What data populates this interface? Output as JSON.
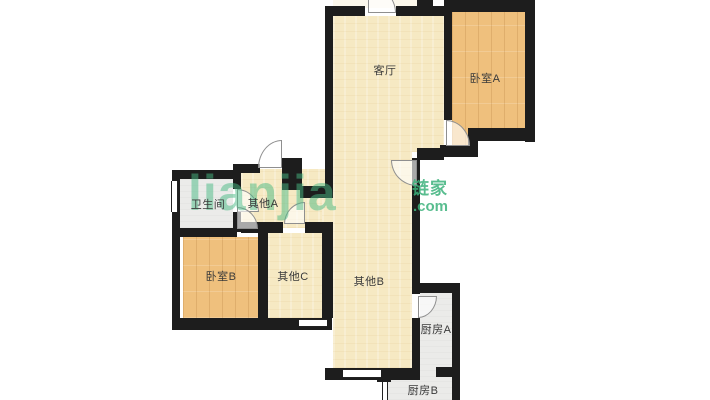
{
  "watermark": {
    "logo": "lianjia",
    "brand": "链家",
    "tld": ".com",
    "color": "#48b983"
  },
  "colors": {
    "wall": "#1d1d1d",
    "room_beige": "#f6e9c3",
    "room_wood": "#efc07d",
    "room_gray": "#ebebe9",
    "balcony_ivory": "#fcf8ec"
  },
  "rooms": [
    {
      "id": "living",
      "label": "客厅"
    },
    {
      "id": "bedroom-a",
      "label": "卧室A"
    },
    {
      "id": "bathroom",
      "label": "卫生间"
    },
    {
      "id": "other-a",
      "label": "其他A"
    },
    {
      "id": "bedroom-b",
      "label": "卧室B"
    },
    {
      "id": "other-c",
      "label": "其他C"
    },
    {
      "id": "other-b",
      "label": "其他B"
    },
    {
      "id": "kitchen-a",
      "label": "厨房A"
    },
    {
      "id": "kitchen-b",
      "label": "厨房B"
    }
  ]
}
